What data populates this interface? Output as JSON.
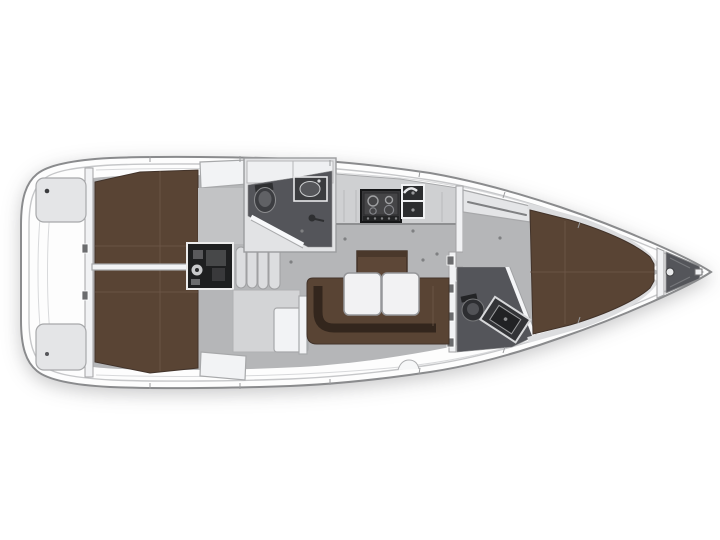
{
  "diagram": {
    "type": "yacht-interior-floor-plan",
    "subject": "sailing-yacht-layout-top-view",
    "orientation": "bow-right-stern-left",
    "text_labels": [],
    "areas": [
      {
        "name": "transom-swim-platform",
        "fixtures": [
          "stern-locker-top",
          "stern-locker-bottom",
          "transom-bulkhead"
        ]
      },
      {
        "name": "aft-cabin-starboard",
        "fixtures": [
          "double-berth",
          "locker"
        ]
      },
      {
        "name": "aft-cabin-port",
        "fixtures": [
          "double-berth",
          "locker",
          "cabinet"
        ]
      },
      {
        "name": "engine-compartment",
        "fixtures": [
          "engine-block"
        ]
      },
      {
        "name": "companionway",
        "fixtures": [
          "steps-4"
        ]
      },
      {
        "name": "aft-heads",
        "fixtures": [
          "toilet",
          "washbasin",
          "shower-mixer",
          "door",
          "cabinet-strip"
        ]
      },
      {
        "name": "galley",
        "fixtures": [
          "stove-2-burner",
          "double-sink",
          "faucet",
          "counter",
          "fridge"
        ]
      },
      {
        "name": "salon-dinette",
        "fixtures": [
          "u-shaped-settee",
          "folding-table-two-leaves",
          "centerline-bench",
          "corridor-cabinet"
        ]
      },
      {
        "name": "forward-heads",
        "fixtures": [
          "toilet",
          "vanity-washbasin",
          "door-hinges"
        ]
      },
      {
        "name": "forward-cabin",
        "fixtures": [
          "v-berth",
          "shelf-unit",
          "handrail",
          "entry-floor"
        ]
      },
      {
        "name": "anchor-locker",
        "fixtures": [
          "windlass",
          "forestay-fitting",
          "bow-bulkhead"
        ]
      }
    ]
  },
  "palette": {
    "hull_fill": "#fdfdfd",
    "hull_stroke": "#8a8b8d",
    "deck_line": "#c6c7c9",
    "coach_line": "#d8d9db",
    "floor_gray": "#b5b6b8",
    "berth_brown": "#594434",
    "berth_edge": "#42332a",
    "seam": "#6d5748",
    "settee_brown": "#5d4737",
    "settee_accent": "#33261d",
    "light_furniture": "#e4e5e7",
    "white_fixture": "#f2f3f5",
    "furniture_stroke": "#a7a8aa",
    "counter": "#cfd0d2",
    "bath_floor": "#54555a",
    "fixture_dark": "#2d2e31",
    "engine_dark": "#1e1f20",
    "step_fill": "#dcdddf",
    "table_white": "#f2f2f3",
    "background": "#ffffff"
  }
}
